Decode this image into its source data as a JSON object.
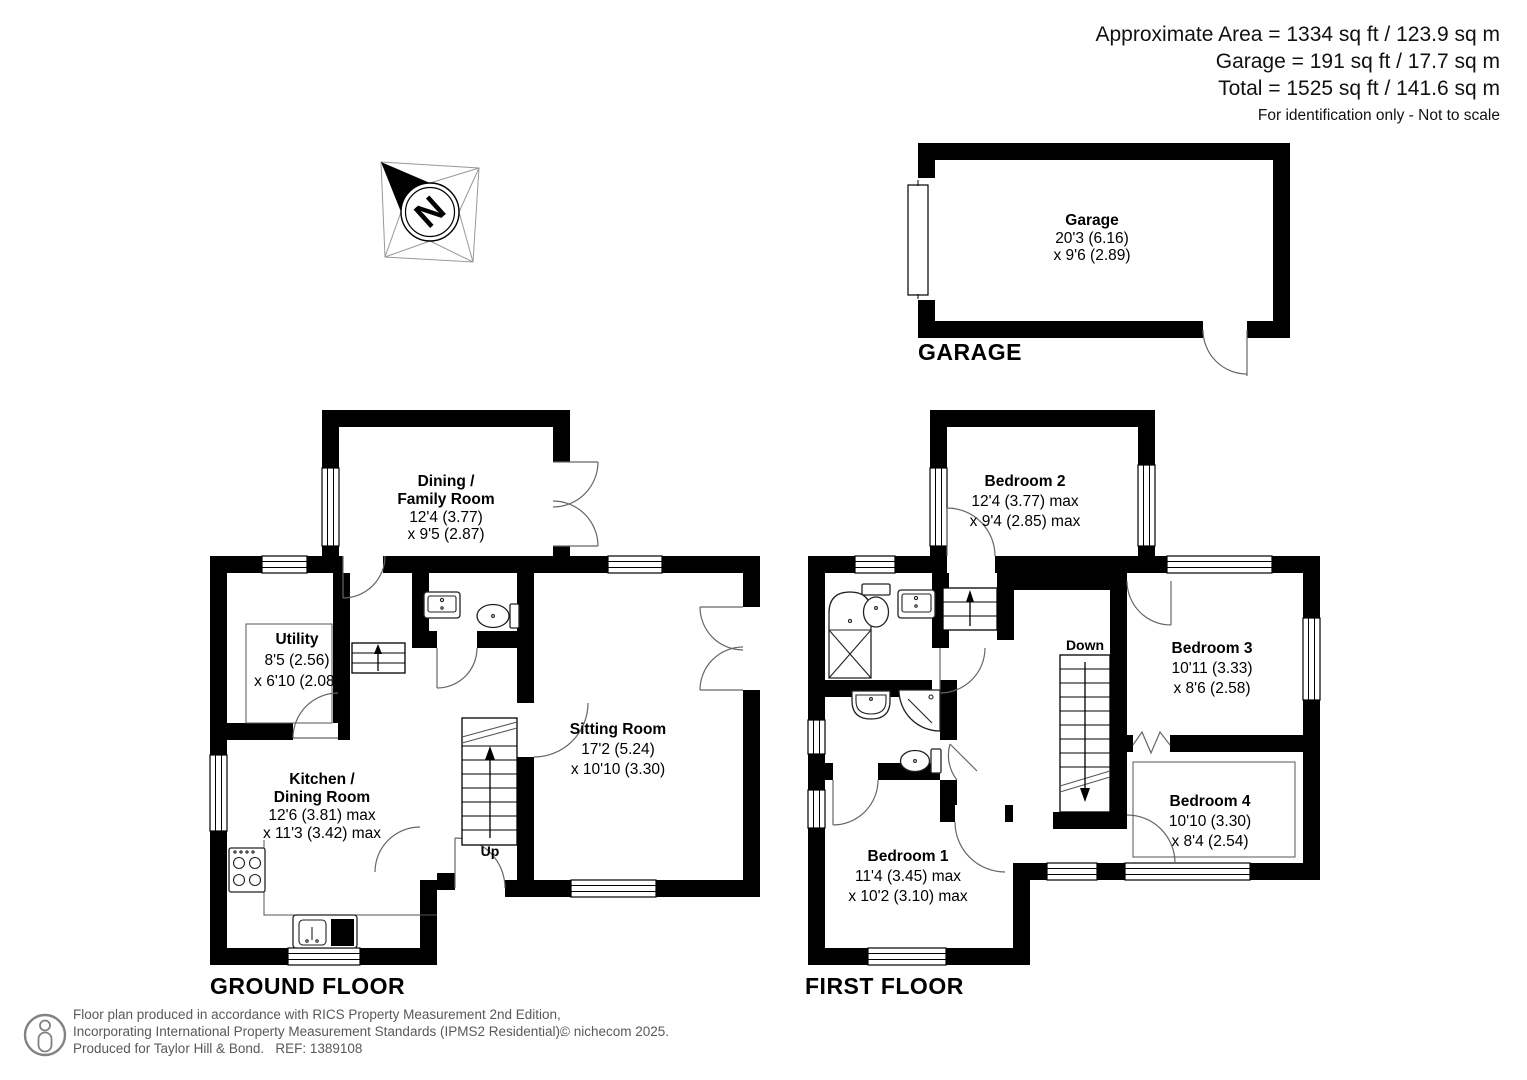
{
  "header": {
    "approximate_area": "Approximate Area = 1334 sq ft / 123.9 sq m",
    "garage_area": "Garage = 191 sq ft / 17.7 sq m",
    "total_area": "Total = 1525 sq ft / 141.6 sq m",
    "note": "For identification only - Not to scale"
  },
  "compass": {
    "letter": "N"
  },
  "garage_plan": {
    "floor_label": "GARAGE",
    "room": {
      "name": "Garage",
      "dim1": "20'3 (6.16)",
      "dim2": "x 9'6 (2.89)"
    }
  },
  "ground_floor": {
    "floor_label": "GROUND FLOOR",
    "stairs_label": "Up",
    "rooms": {
      "dining": {
        "name1": "Dining /",
        "name2": "Family Room",
        "dim1": "12'4 (3.77)",
        "dim2": "x 9'5 (2.87)"
      },
      "utility": {
        "name": "Utility",
        "dim1": "8'5 (2.56)",
        "dim2": "x 6'10 (2.08)"
      },
      "kitchen": {
        "name1": "Kitchen /",
        "name2": "Dining Room",
        "dim1": "12'6 (3.81) max",
        "dim2": "x 11'3 (3.42) max"
      },
      "sitting": {
        "name": "Sitting Room",
        "dim1": "17'2 (5.24)",
        "dim2": "x 10'10 (3.30)"
      }
    }
  },
  "first_floor": {
    "floor_label": "FIRST FLOOR",
    "stairs_label": "Down",
    "rooms": {
      "bedroom1": {
        "name": "Bedroom 1",
        "dim1": "11'4 (3.45) max",
        "dim2": "x 10'2 (3.10) max"
      },
      "bedroom2": {
        "name": "Bedroom 2",
        "dim1": "12'4 (3.77) max",
        "dim2": "x 9'4 (2.85) max"
      },
      "bedroom3": {
        "name": "Bedroom 3",
        "dim1": "10'11 (3.33)",
        "dim2": "x 8'6 (2.58)"
      },
      "bedroom4": {
        "name": "Bedroom 4",
        "dim1": "10'10 (3.30)",
        "dim2": "x 8'4 (2.54)"
      }
    }
  },
  "footer": {
    "line1": "Floor plan produced in accordance with RICS Property Measurement 2nd Edition,",
    "line2": "Incorporating International Property Measurement Standards (IPMS2 Residential).",
    "copyright": "© nichecom 2025.",
    "line3": "Produced for Taylor Hill & Bond.   REF: 1389108"
  },
  "colors": {
    "wall": "#000000",
    "text": "#000000",
    "muted": "#58595b"
  }
}
